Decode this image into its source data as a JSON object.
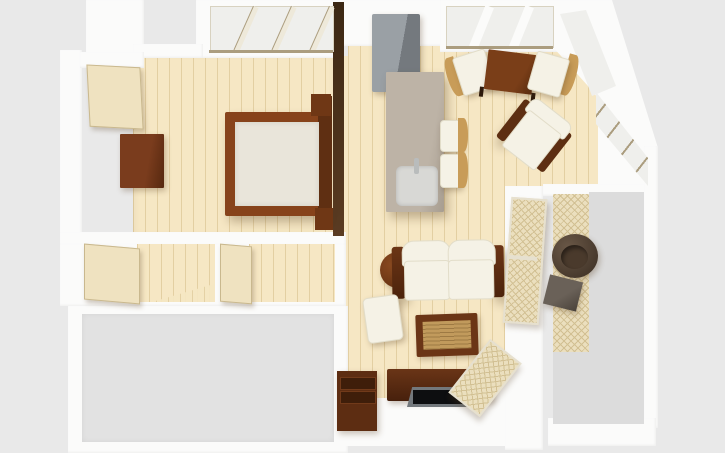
{
  "scene": {
    "kind": "3d-apartment-floor-plan-render",
    "view": "top-down perspective",
    "background": "#e9e9e9"
  },
  "palette": {
    "bg": "#e9e9e9",
    "wall": "#fbfbfa",
    "wood": "#f6e7c4",
    "wood-line": "#e3cfa2",
    "partition": "#4a3018",
    "door-leaf": "#efe2c0",
    "dark-wood": "#5d2e12",
    "sienna": "#87431b",
    "mattress": "#e9e5da",
    "cushion": "#f5f2e6",
    "island": "#b6ab9e",
    "sink": "#d8d8d5",
    "fridge": "#8b9095",
    "glass": "#efefec",
    "mullion": "#ab9d7f",
    "rattan": "#c19a5c",
    "stool-back": "#c89c58",
    "balcony-floor": "#dcdcdc",
    "mat": "#ebdfbe",
    "mat-line": "#d2c093",
    "tv-frame": "#73787c",
    "tv-screen": "#0d0e10",
    "gray-room": "#e2e2e2",
    "tub-chair": "#4c3b2d",
    "balcony-table": "#5a5149"
  },
  "rooms": [
    {
      "name": "bedroom"
    },
    {
      "name": "kitchen"
    },
    {
      "name": "dining-area"
    },
    {
      "name": "living-room"
    },
    {
      "name": "hallway"
    },
    {
      "name": "storage-rooms"
    },
    {
      "name": "balcony"
    },
    {
      "name": "lower-room"
    }
  ],
  "objects": {
    "entry_door": "entry door (open)",
    "dresser": "dresser",
    "bed": "double bed",
    "partition": "partition wall",
    "bedroom_window": "bedroom window",
    "dining_window": "dining window",
    "corner_window": "corner window",
    "side_window": "side window wall",
    "fridge": "refrigerator",
    "island": "kitchen island with sink",
    "stool": "bar stool",
    "dining_table": "dining table",
    "dining_chair": "dining chair",
    "armchair": "armchair",
    "sofa": "two-seat sofa",
    "side_table": "round side table",
    "ottoman": "ottoman",
    "coffee_table": "rattan coffee table",
    "tv_console": "TV stand",
    "tv": "flat-screen TV",
    "cabinet": "storage cabinet",
    "room_door": "interior door (open)",
    "door_swing": "door swing mark",
    "balcony_door": "sliding balcony door panel",
    "tub_chair": "balcony tub chair",
    "balcony_side_table": "balcony side table"
  }
}
